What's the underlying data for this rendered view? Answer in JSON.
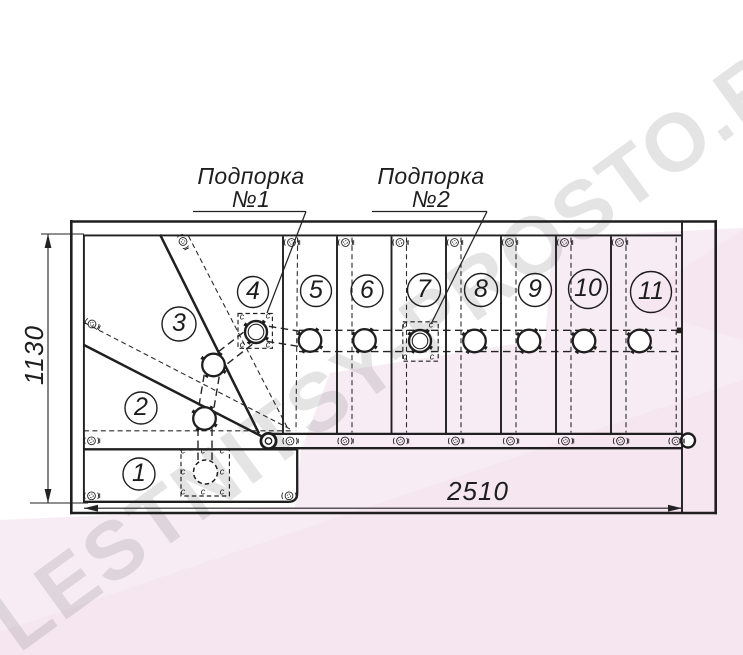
{
  "watermark": {
    "text": "LESTNITSY-PROSTO.RU"
  },
  "callout1": {
    "line1": "Подпорка",
    "line2": "№1"
  },
  "callout2": {
    "line1": "Подпорка",
    "line2": "№2"
  },
  "dimensions": {
    "width": "2510",
    "height": "1130"
  },
  "steps": [
    "1",
    "2",
    "3",
    "4",
    "5",
    "6",
    "7",
    "8",
    "9",
    "10",
    "11"
  ],
  "marks": {
    "char": "c"
  },
  "colors": {
    "line": "#222222",
    "pink_light": "#f7ecf3",
    "pink_deep": "#f3e0ec",
    "watermark_gray": "rgba(95,88,96,0.16)"
  }
}
